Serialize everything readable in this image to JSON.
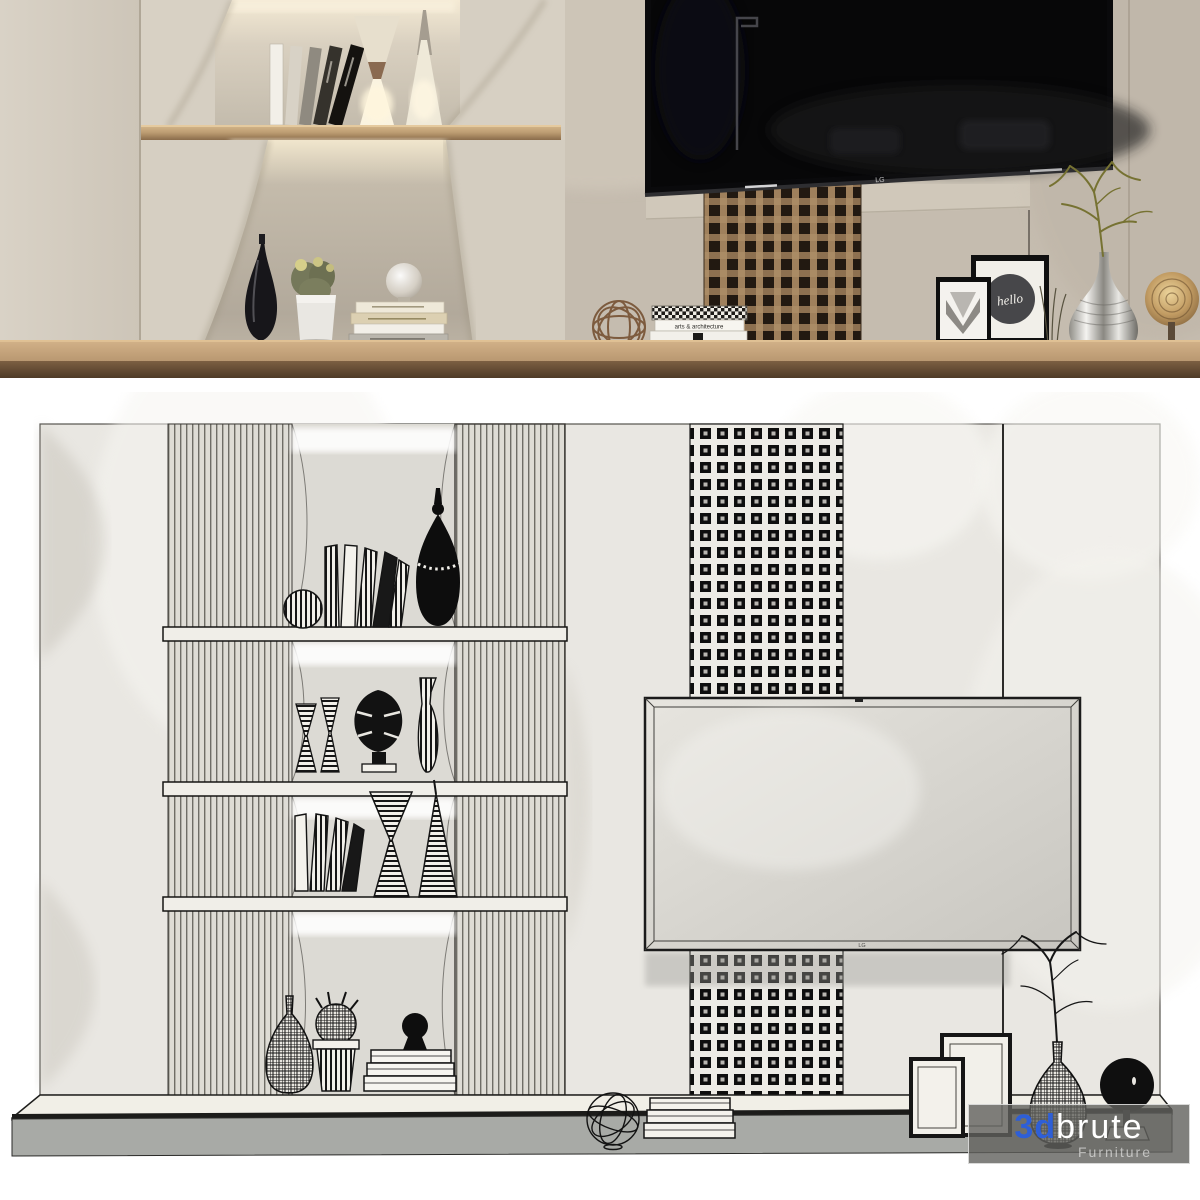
{
  "branding": {
    "prefix": "3d",
    "name": "brute",
    "subtitle": "Furniture",
    "accent_color": "#2e5fd7",
    "panel_color": "rgba(96,96,93,0.8)"
  },
  "tv": {
    "brand_label": "LG"
  },
  "decor_text": {
    "poster_script": "hello",
    "book_spine_fashion": "THE FASHION BOOK",
    "book_spine_arts": "arts & architecture"
  },
  "palette": {
    "wall_beige": "#c8c0b3",
    "cabinet_beige": "#d6cfc2",
    "niche_shadow": "#b3aa9d",
    "wood_shelf": "#c9a87d",
    "wood_counter_top": "#c5a57c",
    "wood_counter_front": "#6b5138",
    "lattice_wood": "#9a7c58",
    "tv_screen": "#0a0a0c",
    "wireframe_panel": "#e9e7e2",
    "wireframe_line": "#1a1a1a",
    "plinth_front": "#a8aaa6"
  }
}
